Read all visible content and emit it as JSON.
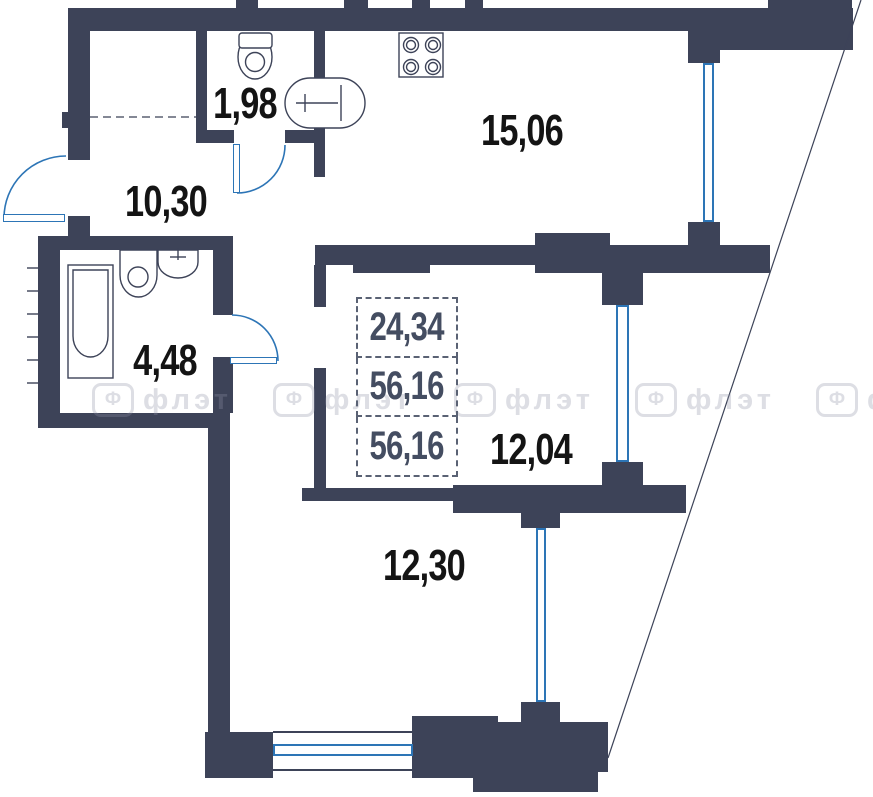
{
  "floor_plan": {
    "stats_box": {
      "living_area": "24,34",
      "total_area": "56,16",
      "total_area_2": "56,16"
    },
    "rooms": [
      {
        "id": "wc",
        "area": "1,98"
      },
      {
        "id": "kitchen",
        "area": "15,06"
      },
      {
        "id": "hallway",
        "area": "10,30"
      },
      {
        "id": "bathroom",
        "area": "4,48"
      },
      {
        "id": "bedroom",
        "area": "12,04"
      },
      {
        "id": "living-room",
        "area": "12,30"
      }
    ],
    "watermark": {
      "icon_letter": "Ф",
      "text": "флэт"
    },
    "colors": {
      "wall": "#3d4358",
      "window_blue": "#2d75b6",
      "label": "#141414",
      "stats": "#444d61"
    }
  }
}
